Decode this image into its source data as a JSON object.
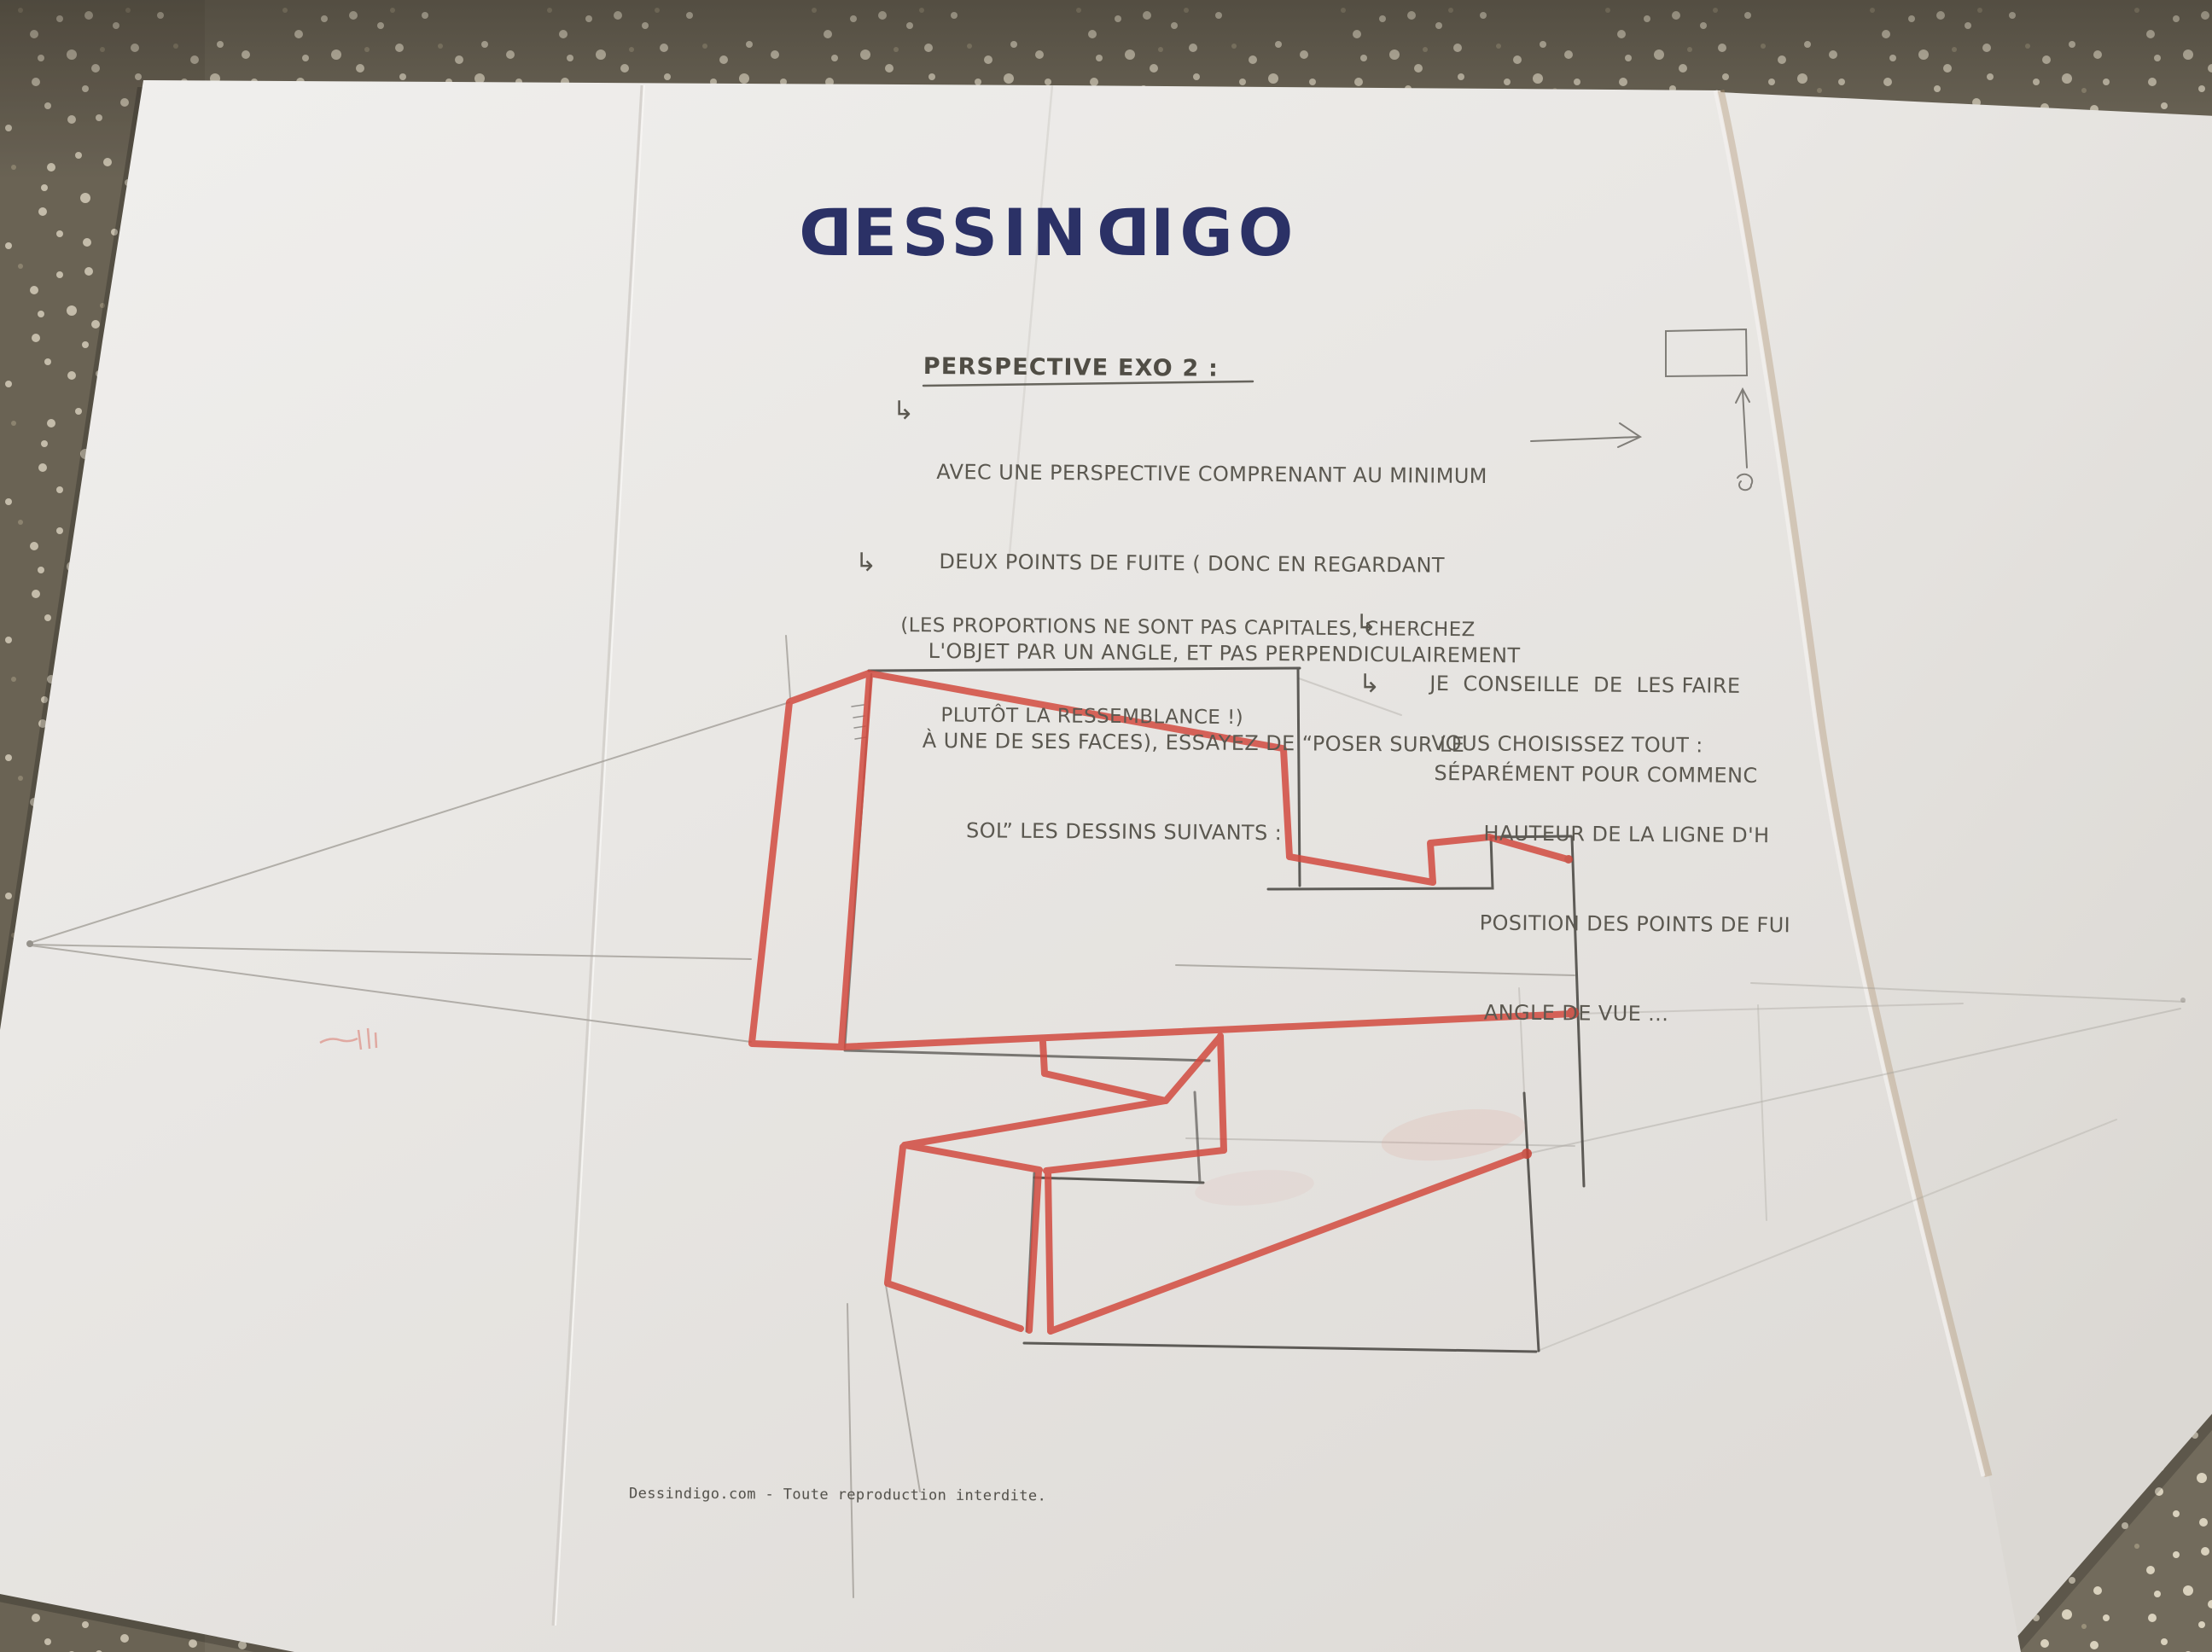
{
  "logo": {
    "d1": "D",
    "seg1": "ESSIN",
    "d2": "D",
    "seg2": "IGO"
  },
  "worksheet": {
    "heading": "PERSPECTIVE EXO 2 :",
    "arrow_elbow": "↳",
    "intro": {
      "lines": [
        "AVEC UNE PERSPECTIVE COMPRENANT AU MINIMUM",
        "DEUX POINTS DE FUITE ( DONC EN REGARDANT",
        "L'OBJET PAR UN ANGLE, ET PAS PERPENDICULAIREMENT",
        "À UNE DE SES FACES), ESSAYEZ DE “POSER SUR LE",
        "SOL” LES DESSINS SUIVANTS :"
      ]
    },
    "note": {
      "lines": [
        "(LES PROPORTIONS NE SONT PAS CAPITALES, CHERCHEZ",
        "PLUTÔT LA RESSEMBLANCE !)"
      ]
    },
    "advice1": {
      "lines": [
        "JE  CONSEILLE  DE  LES FAIRE",
        "SÉPARÉMENT POUR COMMENC"
      ]
    },
    "advice2": {
      "intro": "VOUS CHOISISSEZ TOUT :",
      "lines": [
        "HAUTEUR DE LA LIGNE D'H",
        "POSITION DES POINTS DE FUI",
        "ANGLE DE VUE ..."
      ]
    },
    "footer": "Dessindigo.com - Toute reproduction interdite."
  },
  "colors": {
    "marker_red": "#d24b40",
    "pencil_dark": "#4b4844",
    "pencil_faint": "#a9a6a0",
    "logo_navy": "#2b3166",
    "paper_white": "#e9e7e4",
    "fabric_taupe": "#756e60"
  }
}
